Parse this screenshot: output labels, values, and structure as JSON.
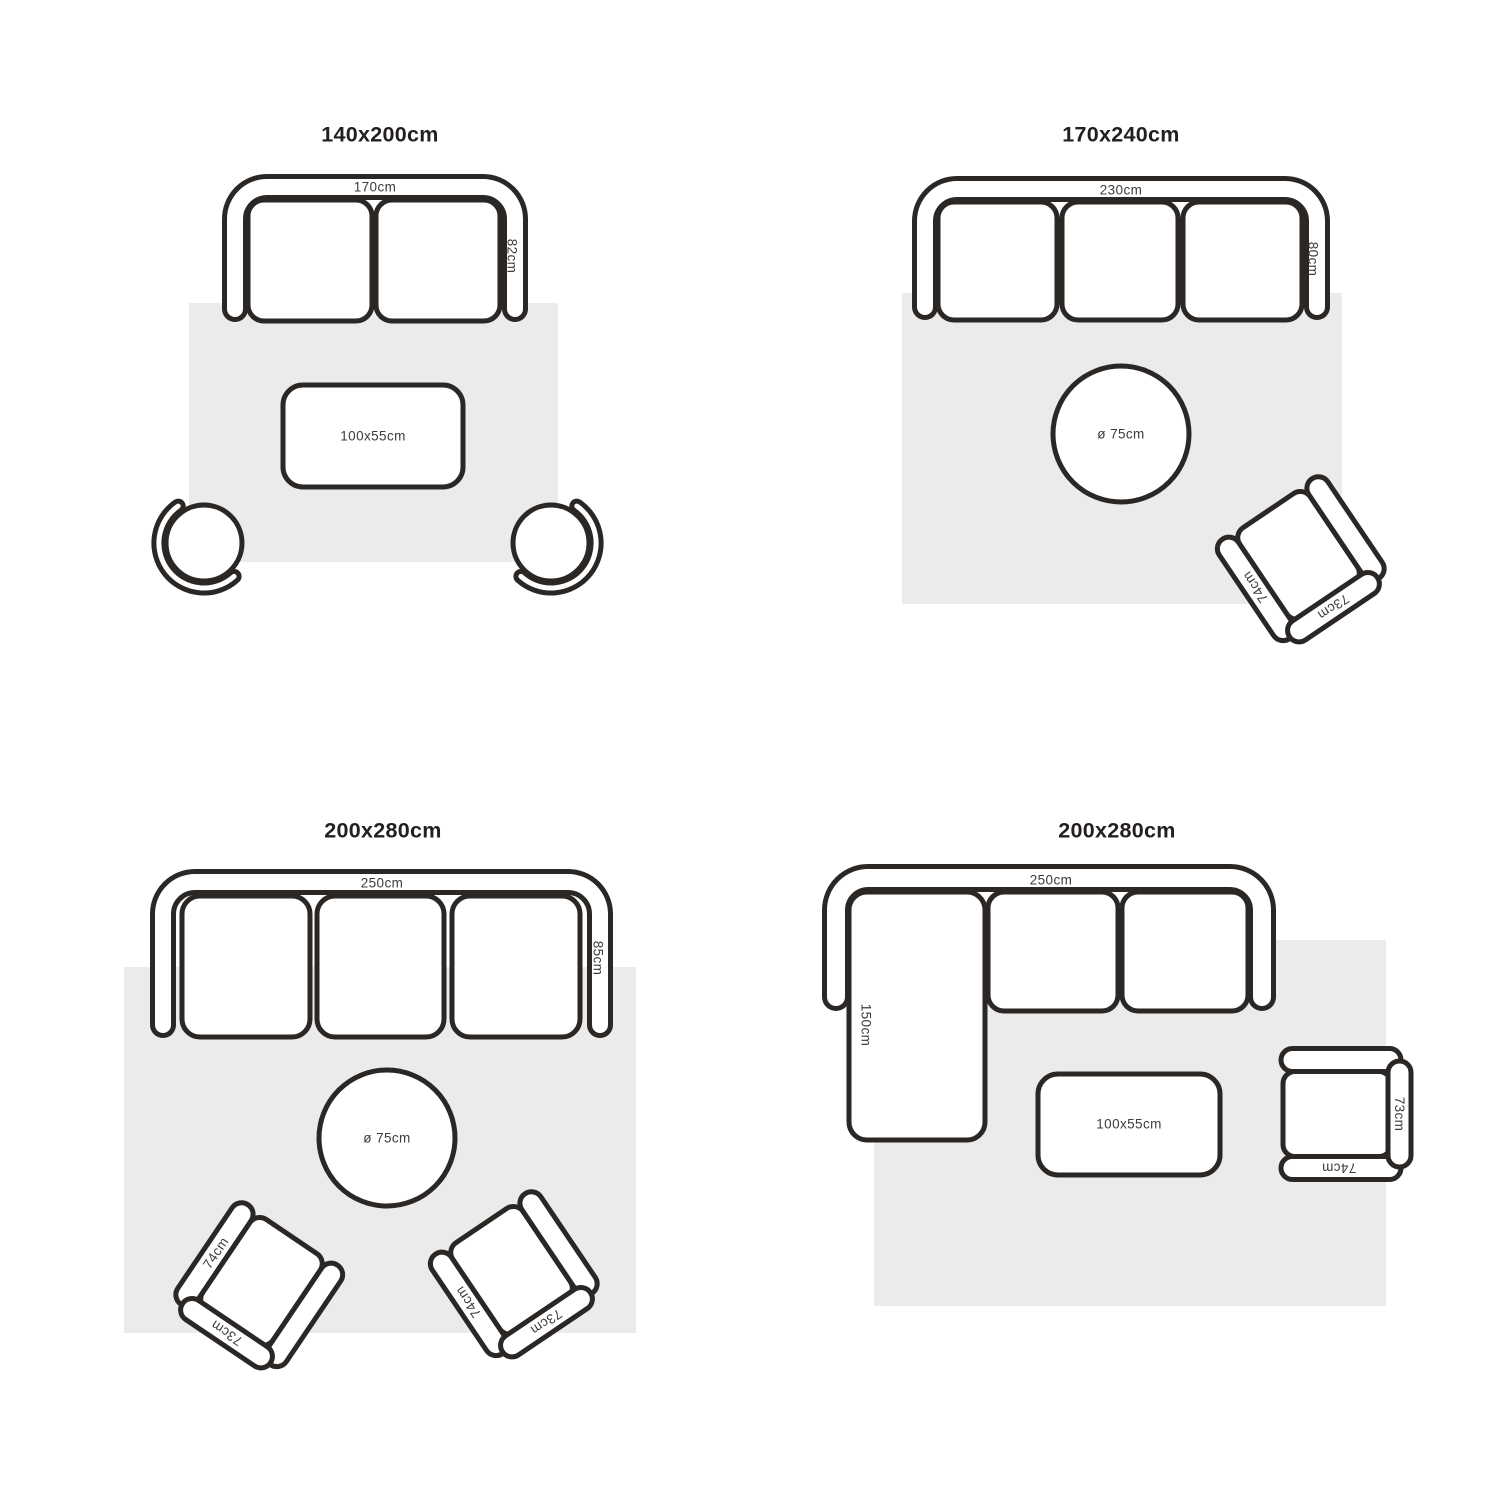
{
  "colors": {
    "background": "#ffffff",
    "outline": "#2b2725",
    "rug": "#ebebeb",
    "label_text": "#3f3b39",
    "title_text": "#242021"
  },
  "quadrants": [
    {
      "id": "top-left",
      "title": "140x200cm",
      "sofa": {
        "type": "2-seat sofa",
        "width_label": "170cm",
        "depth_label": "82cm"
      },
      "coffee_table": {
        "label": "100x55cm"
      }
    },
    {
      "id": "top-right",
      "title": "170x240cm",
      "sofa": {
        "type": "3-seat sofa",
        "width_label": "230cm",
        "depth_label": "80cm"
      },
      "round_table": {
        "label": "ø 75cm"
      },
      "armchair": {
        "arm_label": "74cm",
        "back_label": "73cm"
      }
    },
    {
      "id": "bottom-left",
      "title": "200x280cm",
      "sofa": {
        "type": "3-seat sofa",
        "width_label": "250cm",
        "depth_label": "85cm"
      },
      "round_table": {
        "label": "ø 75cm"
      },
      "armchairs": [
        {
          "arm_label": "74cm",
          "back_label": "73cm"
        },
        {
          "arm_label": "74cm",
          "back_label": "73cm"
        }
      ]
    },
    {
      "id": "bottom-right",
      "title": "200x280cm",
      "sofa": {
        "type": "corner-sectional sofa",
        "width_label": "250cm",
        "chaise_label": "150cm"
      },
      "coffee_table": {
        "label": "100x55cm"
      },
      "armchair": {
        "arm_label": "74cm",
        "back_label": "73cm"
      }
    }
  ]
}
